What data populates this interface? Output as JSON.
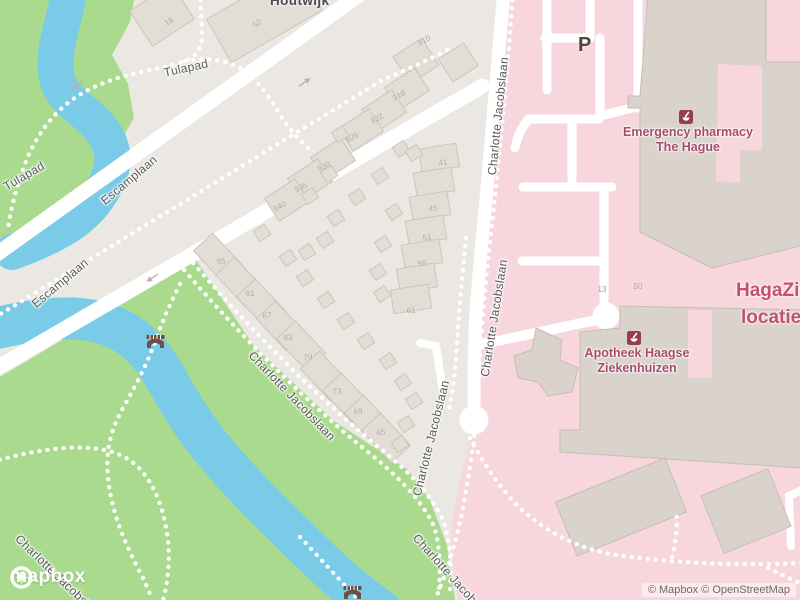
{
  "colors": {
    "water": "#79cbe8",
    "park_green": "#a9da8d",
    "hospital_pink": "#f7d6de",
    "base_gray": "#ebe8e3",
    "road_white": "#ffffff",
    "poi_text": "#a94b68",
    "hospital_title_text": "#c2506e"
  },
  "branding": {
    "logo_text": "mapbox",
    "attribution": "© Mapbox © OpenStreetMap"
  },
  "labels": {
    "neighborhood": "Houtwijk",
    "parking": "P",
    "hospital_name_line1": "HagaZiek",
    "hospital_name_line2": "locatie L",
    "pois": [
      {
        "id": "emergency-pharmacy",
        "line1": "Emergency pharmacy",
        "line2": "The Hague"
      },
      {
        "id": "apotheek-haagse-ziekenhuizen",
        "line1": "Apotheek Haagse",
        "line2": "Ziekenhuizen"
      }
    ],
    "streets": [
      {
        "text": "Tulapad"
      },
      {
        "text": "Tulapad"
      },
      {
        "text": "Escamplaan"
      },
      {
        "text": "Escamplaan"
      },
      {
        "text": "Charlotte Jacobslaan"
      },
      {
        "text": "Charlotte Jacobslaan"
      },
      {
        "text": "Charlotte Jacobslaan"
      },
      {
        "text": "Charlotte Jacobslaan"
      },
      {
        "text": "Charlotte Jacobslaan"
      },
      {
        "text": "Charlotte Jacobslaan"
      }
    ]
  },
  "house_numbers": [
    {
      "v": "918"
    },
    {
      "v": "922"
    },
    {
      "v": "926"
    },
    {
      "v": "930"
    },
    {
      "v": "936"
    },
    {
      "v": "940"
    },
    {
      "v": "16"
    },
    {
      "v": "52"
    },
    {
      "v": "910"
    },
    {
      "v": "41"
    },
    {
      "v": "45"
    },
    {
      "v": "51"
    },
    {
      "v": "55"
    },
    {
      "v": "61"
    },
    {
      "v": "95"
    },
    {
      "v": "91"
    },
    {
      "v": "87"
    },
    {
      "v": "83"
    },
    {
      "v": "79"
    },
    {
      "v": "73"
    },
    {
      "v": "69"
    },
    {
      "v": "65"
    },
    {
      "v": "13"
    },
    {
      "v": "50"
    }
  ]
}
